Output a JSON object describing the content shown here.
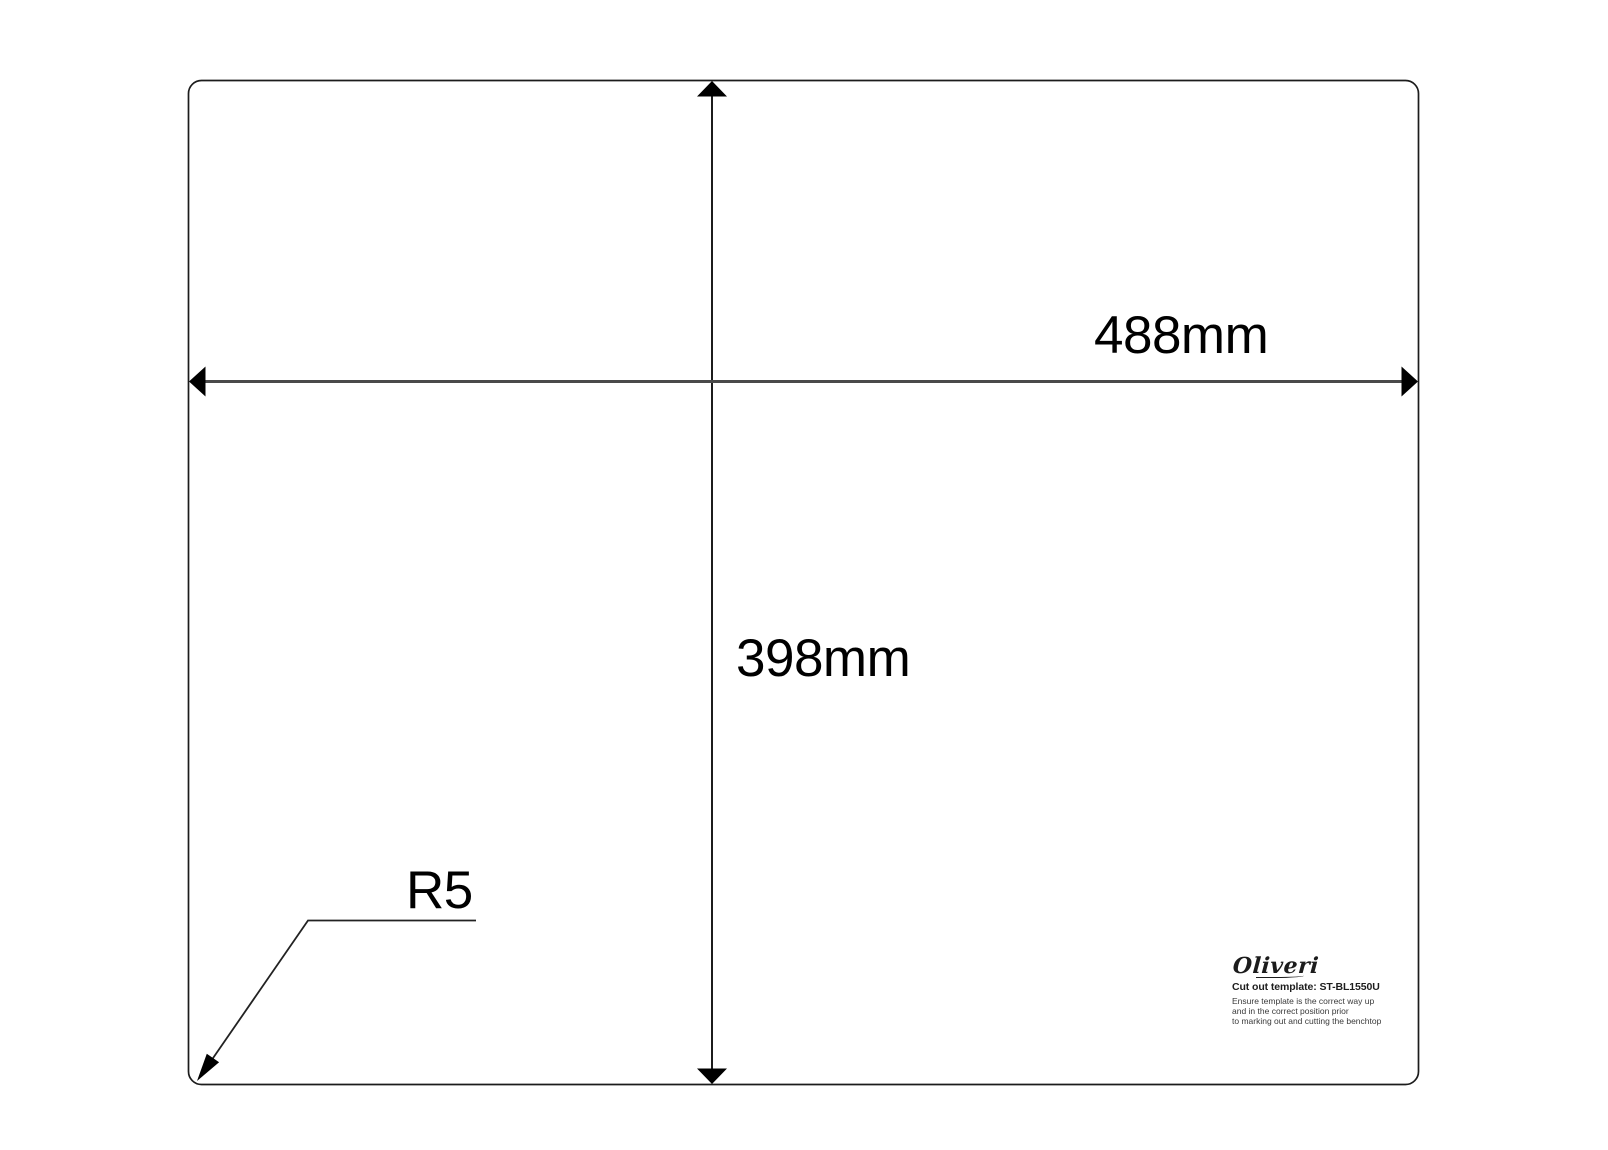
{
  "drawing": {
    "width_label": "488mm",
    "height_label": "398mm",
    "corner_radius_label": "R5"
  },
  "branding": {
    "logo": "Oliveri",
    "template_title": "Cut out template: ST-BL1550U",
    "instructions": [
      "Ensure template is the correct way up",
      "and in the correct position prior",
      "to marking out and cutting the benchtop"
    ]
  },
  "colors": {
    "outline": "#1c1c1c",
    "dimension_line": "#4a4a4a",
    "arrowhead": "#000000",
    "label_text": "#000000"
  }
}
